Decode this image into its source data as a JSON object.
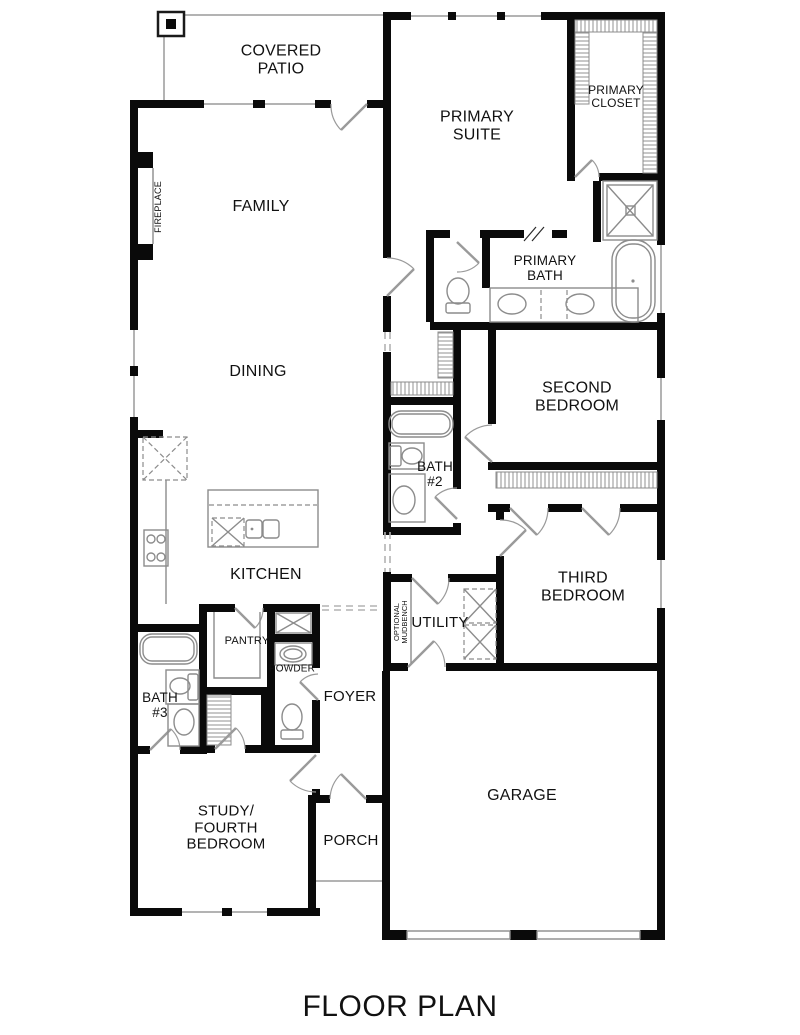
{
  "title": {
    "text": "FLOOR PLAN"
  },
  "colors": {
    "wall": "#0a0a0a",
    "background": "#ffffff",
    "window_line": "#b3b3b3",
    "patio_line": "#9a9a9a",
    "fixture_line": "#8c8c8c",
    "door_line": "#9a9a9a",
    "hatch_line": "#9a9a9a",
    "text": "#111111"
  },
  "rooms": {
    "covered_patio": {
      "label": "COVERED\nPATIO"
    },
    "primary_suite": {
      "label": "PRIMARY\nSUITE"
    },
    "primary_closet": {
      "label": "PRIMARY\nCLOSET"
    },
    "family": {
      "label": "FAMILY"
    },
    "fireplace": {
      "label": "FIREPLACE"
    },
    "primary_bath": {
      "label": "PRIMARY\nBATH"
    },
    "dining": {
      "label": "DINING"
    },
    "second_bedroom": {
      "label": "SECOND\nBEDROOM"
    },
    "bath_2": {
      "label": "BATH\n#2"
    },
    "kitchen": {
      "label": "KITCHEN"
    },
    "third_bedroom": {
      "label": "THIRD\nBEDROOM"
    },
    "utility": {
      "label": "UTILITY"
    },
    "optional_mudbench": {
      "label": "OPTIONAL\nMUDBENCH"
    },
    "pantry": {
      "label": "PANTRY"
    },
    "powder": {
      "label": "POWDER"
    },
    "bath_3": {
      "label": "BATH\n#3"
    },
    "foyer": {
      "label": "FOYER"
    },
    "study": {
      "label": "STUDY/\nFOURTH\nBEDROOM"
    },
    "porch": {
      "label": "PORCH"
    },
    "garage": {
      "label": "GARAGE"
    }
  }
}
